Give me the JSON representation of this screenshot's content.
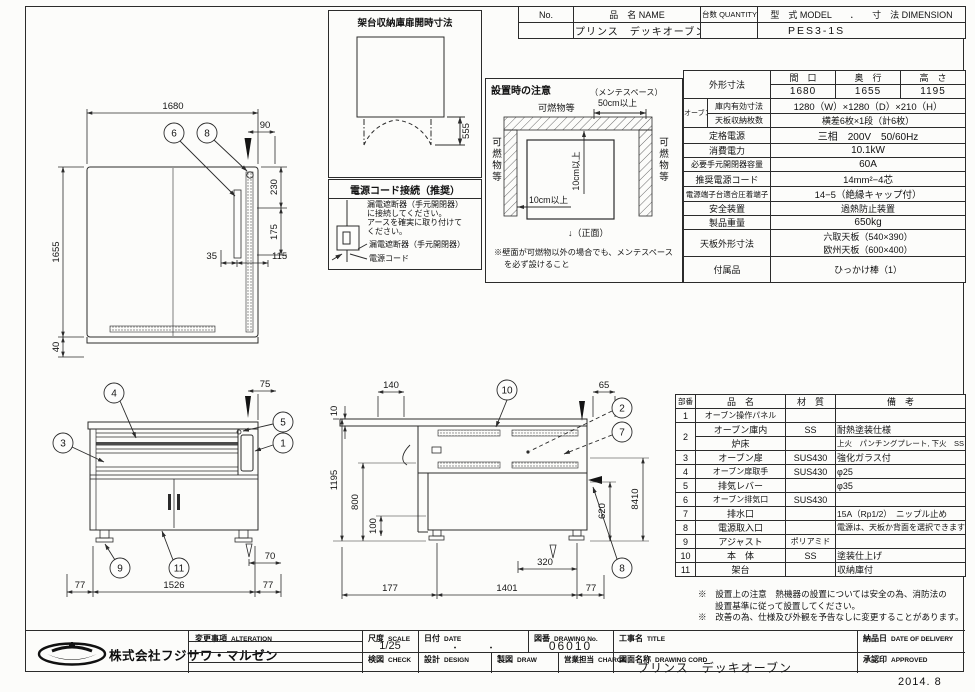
{
  "header_table": {
    "no": "No.",
    "name": "品　名 NAME",
    "qty": "台数 QUANTITY",
    "model_dim": "型　式 MODEL　　．　　寸　法 DIMENSION",
    "name_value": "プリンス　デッキオーブン",
    "model_value": "PES3-1S"
  },
  "spec_table": {
    "outline_label": "外形寸法",
    "w_label": "間　口",
    "d_label": "奥　行",
    "h_label": "高　さ",
    "w": "1680",
    "d": "1655",
    "h": "1195",
    "oven_label": "オーブン",
    "inner_label": "庫内有効寸法",
    "inner_value": "1280（W）×1280（D）×210（H）",
    "tray_label": "天板収納枚数",
    "tray_value": "横差6枚×1段（計6枚）",
    "power_label": "定格電源",
    "power_value": "三相　200V　50/60Hz",
    "consumption_label": "消費電力",
    "consumption_value": "10.1kW",
    "breaker_label": "必要手元開閉器容量",
    "breaker_value": "60A",
    "cord_label": "推奨電源コード",
    "cord_value": "14mm²−4芯",
    "terminal_label": "電源端子台適合圧着端子",
    "terminal_value": "14−5（絶縁キャップ付）",
    "safety_label": "安全装置",
    "safety_value": "過熱防止装置",
    "weight_label": "製品重量",
    "weight_value": "650kg",
    "tray_size_label": "天板外形寸法",
    "tray_size_value1": "六取天板（540×390）",
    "tray_size_value2": "欧州天板（600×400）",
    "accessory_label": "付属品",
    "accessory_value": "ひっかけ棒（1）"
  },
  "parts_table": {
    "h_no": "部番",
    "h_name": "品　名",
    "h_mat": "材　質",
    "h_note": "備　考",
    "rows": [
      {
        "no": "1",
        "name": "オーブン操作パネル",
        "mat": "",
        "note": ""
      },
      {
        "no": "2",
        "name": "オーブン庫内",
        "mat": "SS",
        "note": "耐熱塗装仕様"
      },
      {
        "no": "",
        "name": "炉床",
        "mat": "",
        "note": "上火　パンチングプレート, 下火　SS"
      },
      {
        "no": "3",
        "name": "オーブン扉",
        "mat": "SUS430",
        "note": "強化ガラス付"
      },
      {
        "no": "4",
        "name": "オーブン扉取手",
        "mat": "SUS430",
        "note": "φ25"
      },
      {
        "no": "5",
        "name": "排気レバー",
        "mat": "",
        "note": "φ35"
      },
      {
        "no": "6",
        "name": "オーブン排気口",
        "mat": "SUS430",
        "note": ""
      },
      {
        "no": "7",
        "name": "排水口",
        "mat": "",
        "note": "15A（Rp1/2）　ニップル止め"
      },
      {
        "no": "8",
        "name": "電源取入口",
        "mat": "",
        "note": "電源は、天板か背面を選択できます"
      },
      {
        "no": "9",
        "name": "アジャスト",
        "mat": "ポリアミド",
        "note": ""
      },
      {
        "no": "10",
        "name": "本　体",
        "mat": "SS",
        "note": "塗装仕上げ"
      },
      {
        "no": "11",
        "name": "架台",
        "mat": "",
        "note": "収納庫付"
      }
    ]
  },
  "notes": {
    "line1": "※　設置上の注意　熱機器の設置については安全の為、消防法の",
    "line2": "設置基準に従って設置してください。",
    "line3": "※　改善の為、仕様及び外観を予告なしに変更することがあります。"
  },
  "stand_box": {
    "title": "架台収納庫扉開時寸法",
    "dim555": "555"
  },
  "power_box": {
    "title": "電源コード接続（推奨）",
    "text1": "漏電遮断器（手元開閉器）",
    "text2": "に接続してください。",
    "text3": "アースを確実に取り付けて",
    "text4": "ください。",
    "label_breaker": "漏電遮断器（手元開閉器）",
    "label_cord": "電源コード"
  },
  "install_box": {
    "title": "設置時の注意",
    "maint1": "（メンテスペース）",
    "maint2": "50cm以上",
    "top_label": "可燃物等",
    "left_label": "可燃物等",
    "right_label": "可燃物等",
    "dim_v": "10cm以上",
    "dim_h": "10cm以上",
    "front_label": "↓（正面）",
    "note1": "※壁面が可燃物以外の場合でも、メンテスペース",
    "note2": "を必ず設けること"
  },
  "plan_view": {
    "d1680": "1680",
    "d90": "90",
    "d230": "230",
    "d175": "175",
    "d1655": "1655",
    "d35": "35",
    "d115": "115",
    "d40": "40",
    "b6": "6",
    "b8": "8"
  },
  "front_view": {
    "d75": "75",
    "d70": "70",
    "d77_left": "77",
    "d1526": "1526",
    "d77_right": "77",
    "b1": "1",
    "b3": "3",
    "b4": "4",
    "b5": "5",
    "b9": "9",
    "b11": "11"
  },
  "side_view": {
    "d140": "140",
    "d10": "10",
    "d65": "65",
    "d1195": "1195",
    "d800": "800",
    "d100": "100",
    "d620": "620",
    "d8410": "8410",
    "d320": "320",
    "d177": "177",
    "d1401": "1401",
    "d77": "77",
    "b10": "10",
    "b2": "2",
    "b7": "7",
    "b8": "8"
  },
  "title_block": {
    "company": "株式会社フジサワ・マルゼン",
    "alteration_jp": "変更事項",
    "alteration_en": "ALTERATION",
    "scale_jp": "尺度",
    "scale_en": "SCALE",
    "scale_value": "1/25",
    "date_jp": "日付",
    "date_en": "DATE",
    "date_value": "・　　　・",
    "check_jp": "検図",
    "check_en": "CHECK",
    "design_jp": "設計",
    "design_en": "DESIGN",
    "drawno_jp": "図番",
    "drawno_en": "DRAWING No.",
    "drawno_value": "06010",
    "draw_jp": "製図",
    "draw_en": "DRAW",
    "charge_jp": "営業担当",
    "charge_en": "CHARGE",
    "title_jp": "工事名",
    "title_en": "TITLE",
    "dwgname_jp": "図面名称",
    "dwgname_en": "DRAWING CORD",
    "dwgname_value": "プリンス　デッキオーブン",
    "delivery_jp": "納品日",
    "delivery_en": "DATE OF DELIVERY",
    "approved_jp": "承認印",
    "approved_en": "APPROVED",
    "stamp": "2014. 8"
  }
}
